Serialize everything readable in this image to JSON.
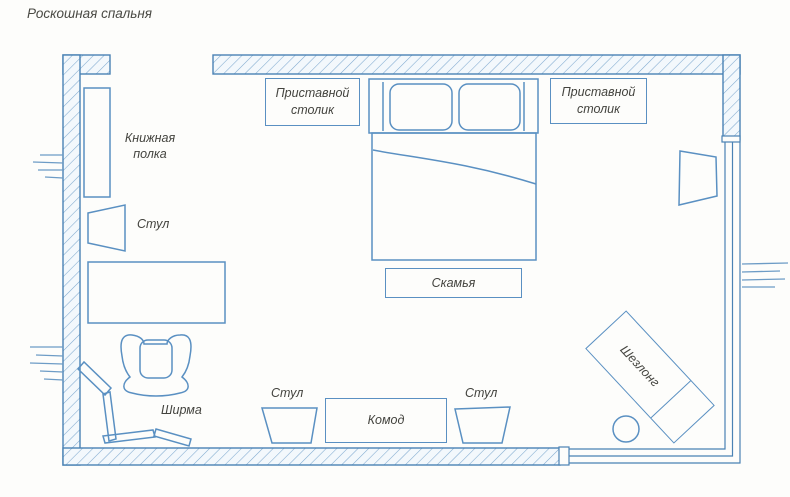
{
  "title": "Роскошная спальня",
  "furniture": {
    "bookshelf": "Книжная полка",
    "chair": "Стул",
    "side_table": "Приставной столик",
    "bed": "Кровать",
    "bench": "Скамья",
    "screen": "Ширма",
    "chest": "Комод",
    "chaise": "Шезлонг"
  },
  "colors": {
    "wall_line": "#4a82b4",
    "hatch_line": "#7fa9cf",
    "furniture_line": "#5a90c2",
    "text": "#44443f",
    "background": "#fdfdfb"
  }
}
